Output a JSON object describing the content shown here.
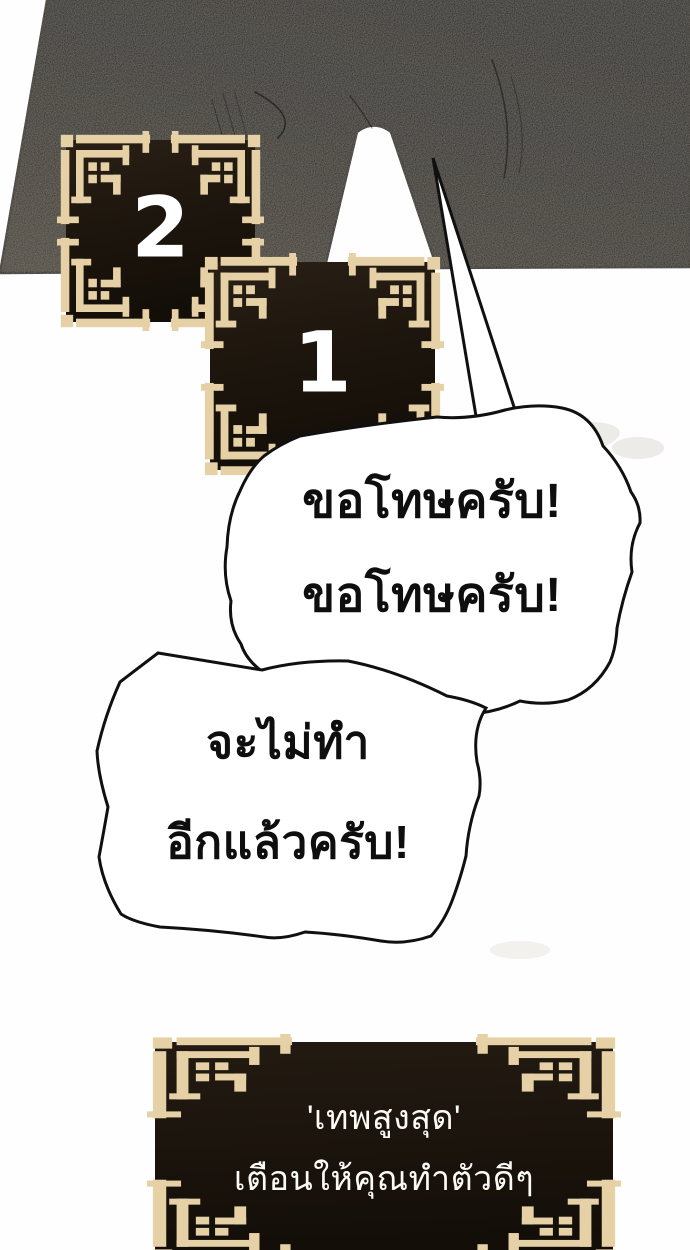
{
  "panel": {
    "countdown_boxes": [
      {
        "value": "2"
      },
      {
        "value": "1"
      }
    ],
    "speech_bubbles": [
      {
        "lines": [
          "ขอโทษครับ!",
          "ขอโทษครับ!"
        ]
      },
      {
        "lines": [
          "จะไม่ทำ",
          "อีกแล้วครับ!"
        ]
      }
    ],
    "system_plaque": {
      "lines": [
        "'เทพสูงสุด'",
        "เตือนให้คุณทำตัวดีๆ"
      ]
    },
    "colors": {
      "ornament_tan": "#e6d0a6",
      "plate_dark": "#1c150d",
      "silhouette_dark": "#14110e",
      "bubble_outline": "#101010",
      "text_white": "#ffffff",
      "text_black": "#0e0e0e"
    }
  }
}
